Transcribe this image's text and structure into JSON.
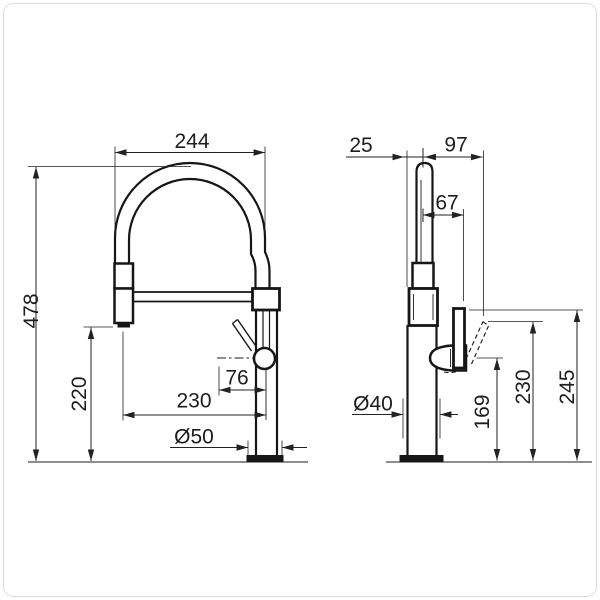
{
  "canvas": {
    "background": "#ffffff",
    "line_color": "#161616",
    "border_color": "#dcdcdc"
  },
  "drawing": {
    "type": "technical-dimension-drawing",
    "units": "mm",
    "subject": "kitchen pull-down spring-spout mixer tap, front and side elevations",
    "front_view": {
      "name": "front elevation",
      "dim_hose_arc_width": "244",
      "dim_overall_height": "478",
      "dim_spray_head_bottom_height": "220",
      "dim_spout_axis_reach": "230",
      "dim_handle_axis_offset": "76",
      "dim_base_diameter": "Ø50"
    },
    "side_view": {
      "name": "side elevation",
      "dim_body_front_to_spout_axis": "25",
      "dim_spout_axis_to_handle_tip_reach": "97",
      "dim_spout_axis_to_lever_reach": "67",
      "dim_base_diameter": "Ø40",
      "dim_handle_pivot_height": "169",
      "dim_tilted_lever_top_height": "230",
      "dim_upright_lever_top_height": "245"
    }
  }
}
